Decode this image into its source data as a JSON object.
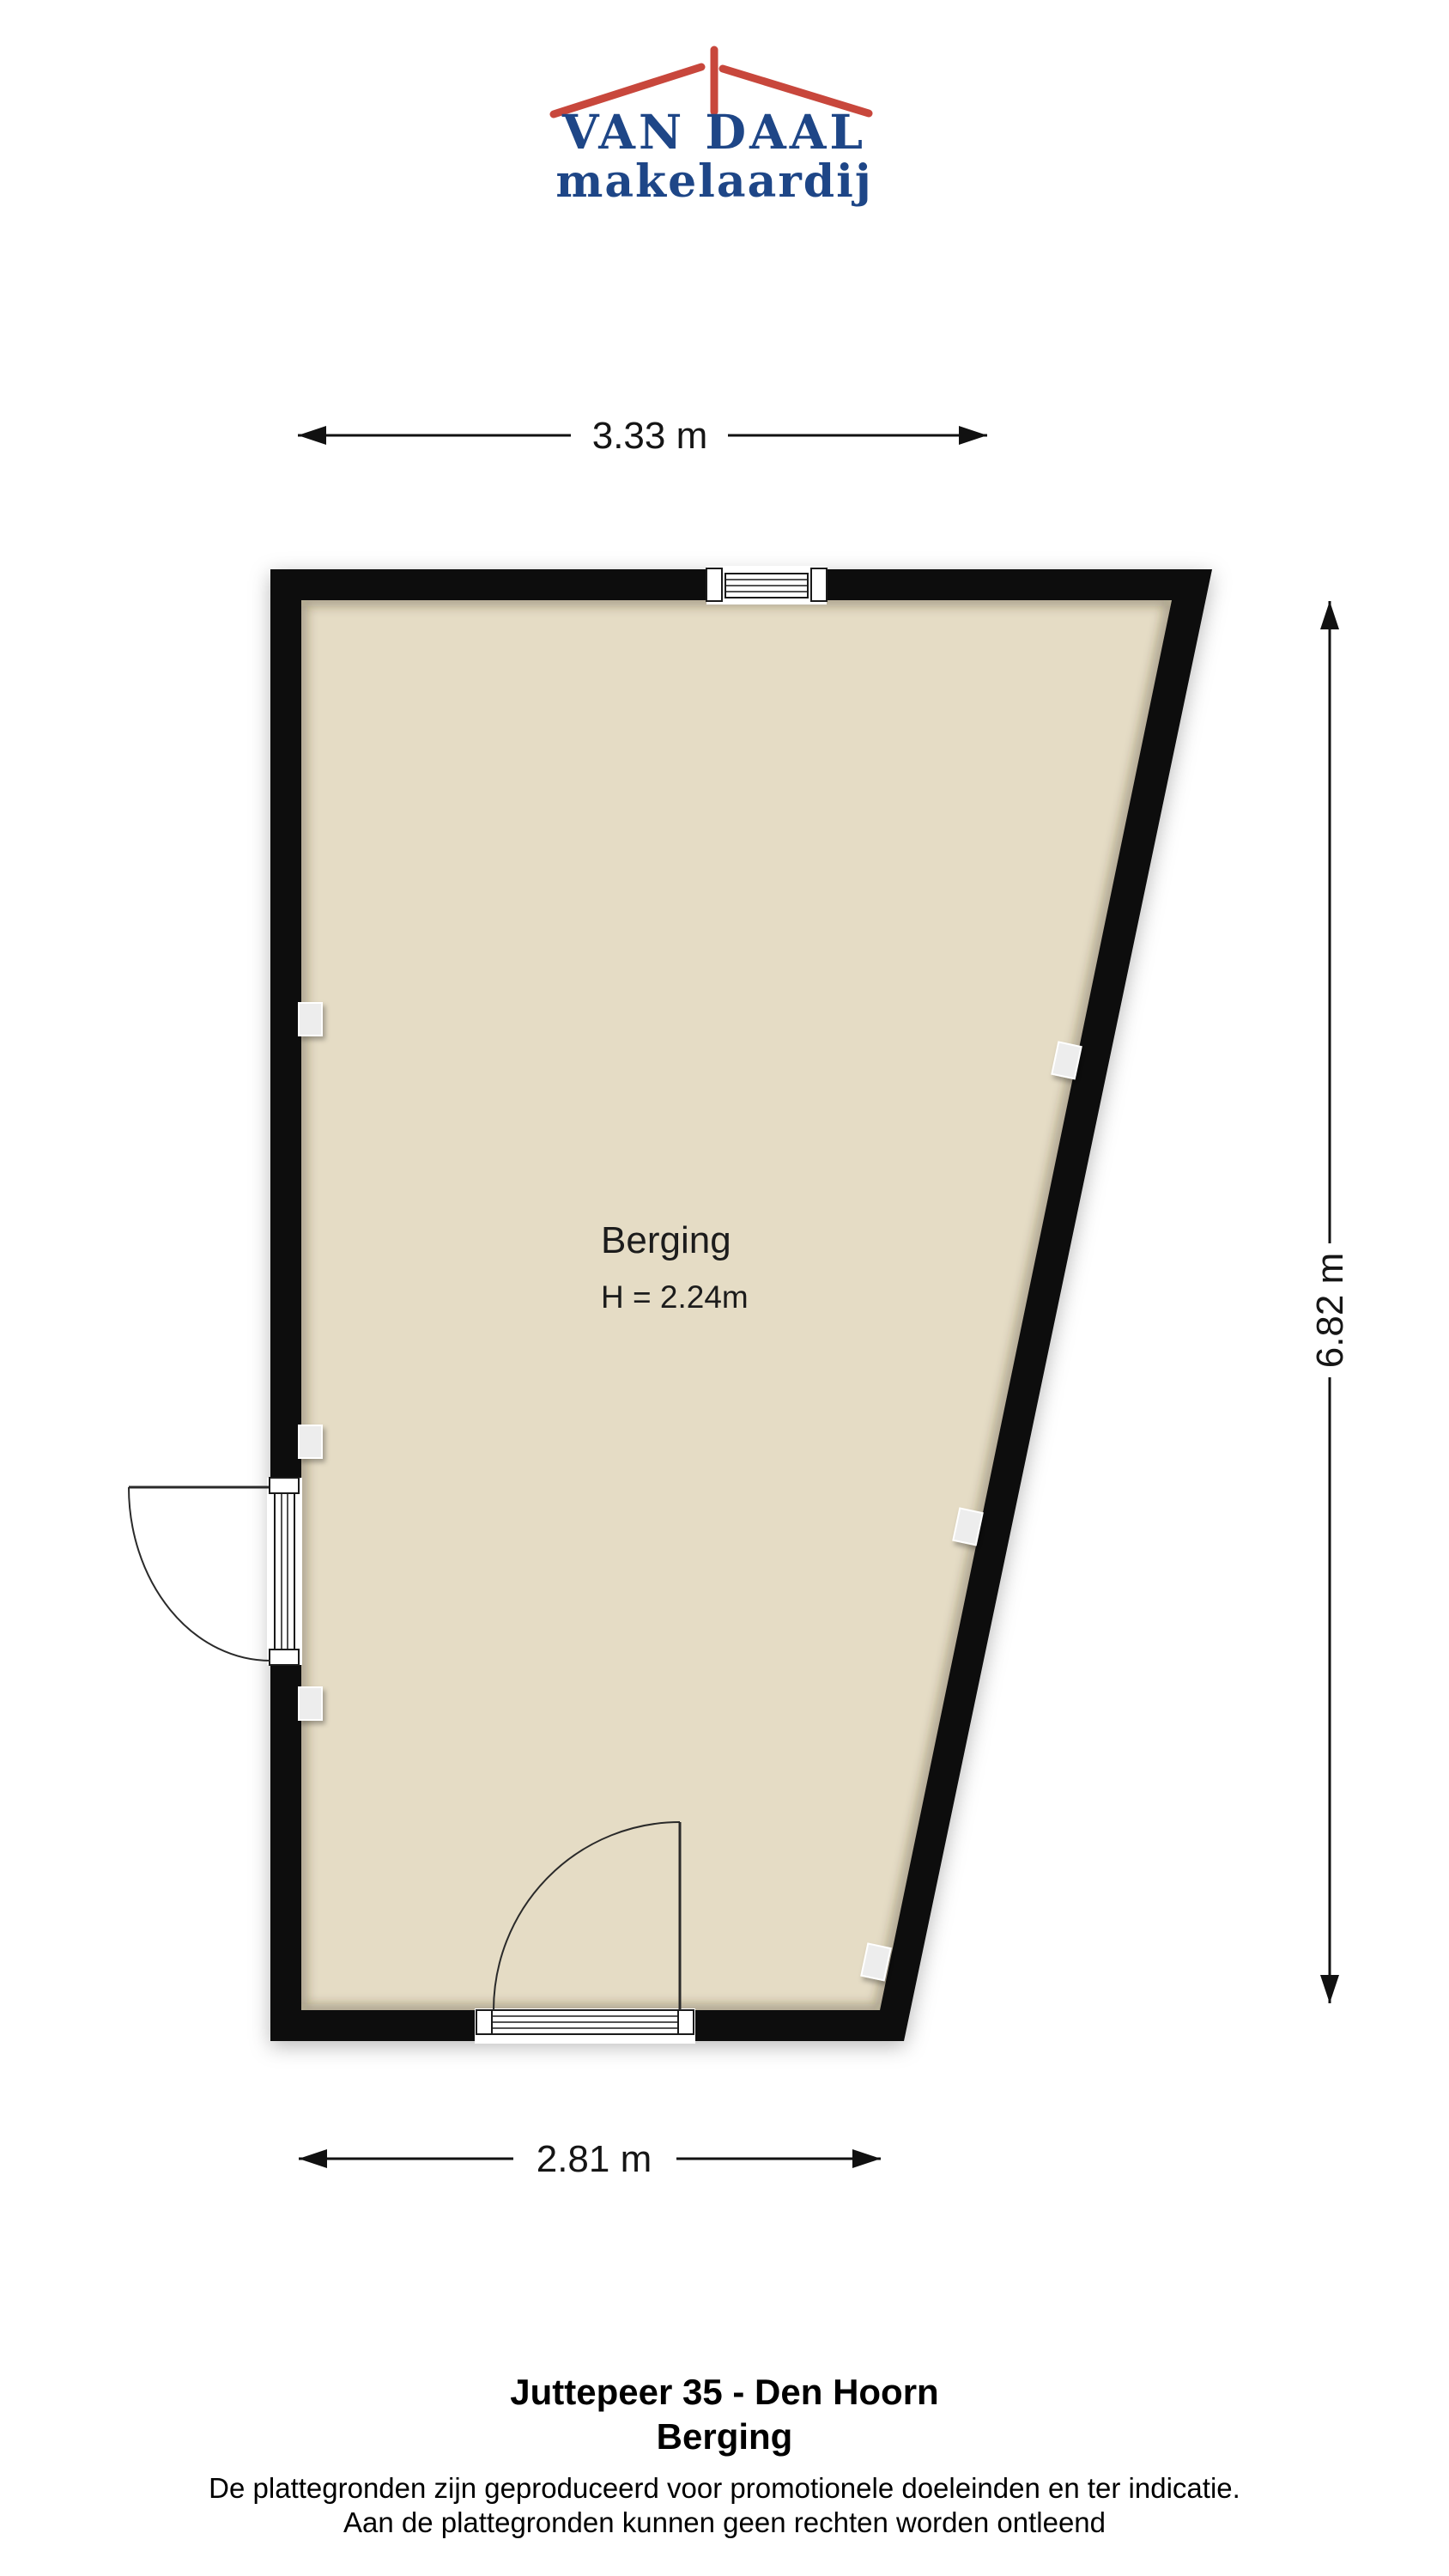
{
  "colors": {
    "brand_red": "#C8473C",
    "brand_blue": "#1E4687",
    "wall": "#070707",
    "floor": "#E5DCC5",
    "fixture": "#EDEDED"
  },
  "logo": {
    "name": "VAN DAAL",
    "subtitle": "makelaardij"
  },
  "dimensions": {
    "top": "3.33 m",
    "right": "6.82 m",
    "bottom": "2.81 m"
  },
  "room": {
    "name": "Berging",
    "height": "H = 2.24m"
  },
  "footer": {
    "address": "Juttepeer 35 - Den Hoorn",
    "room": "Berging",
    "disclaimer1": "De plattegronden zijn geproduceerd voor promotionele doeleinden en ter indicatie.",
    "disclaimer2": "Aan de plattegronden kunnen geen rechten worden ontleend"
  }
}
